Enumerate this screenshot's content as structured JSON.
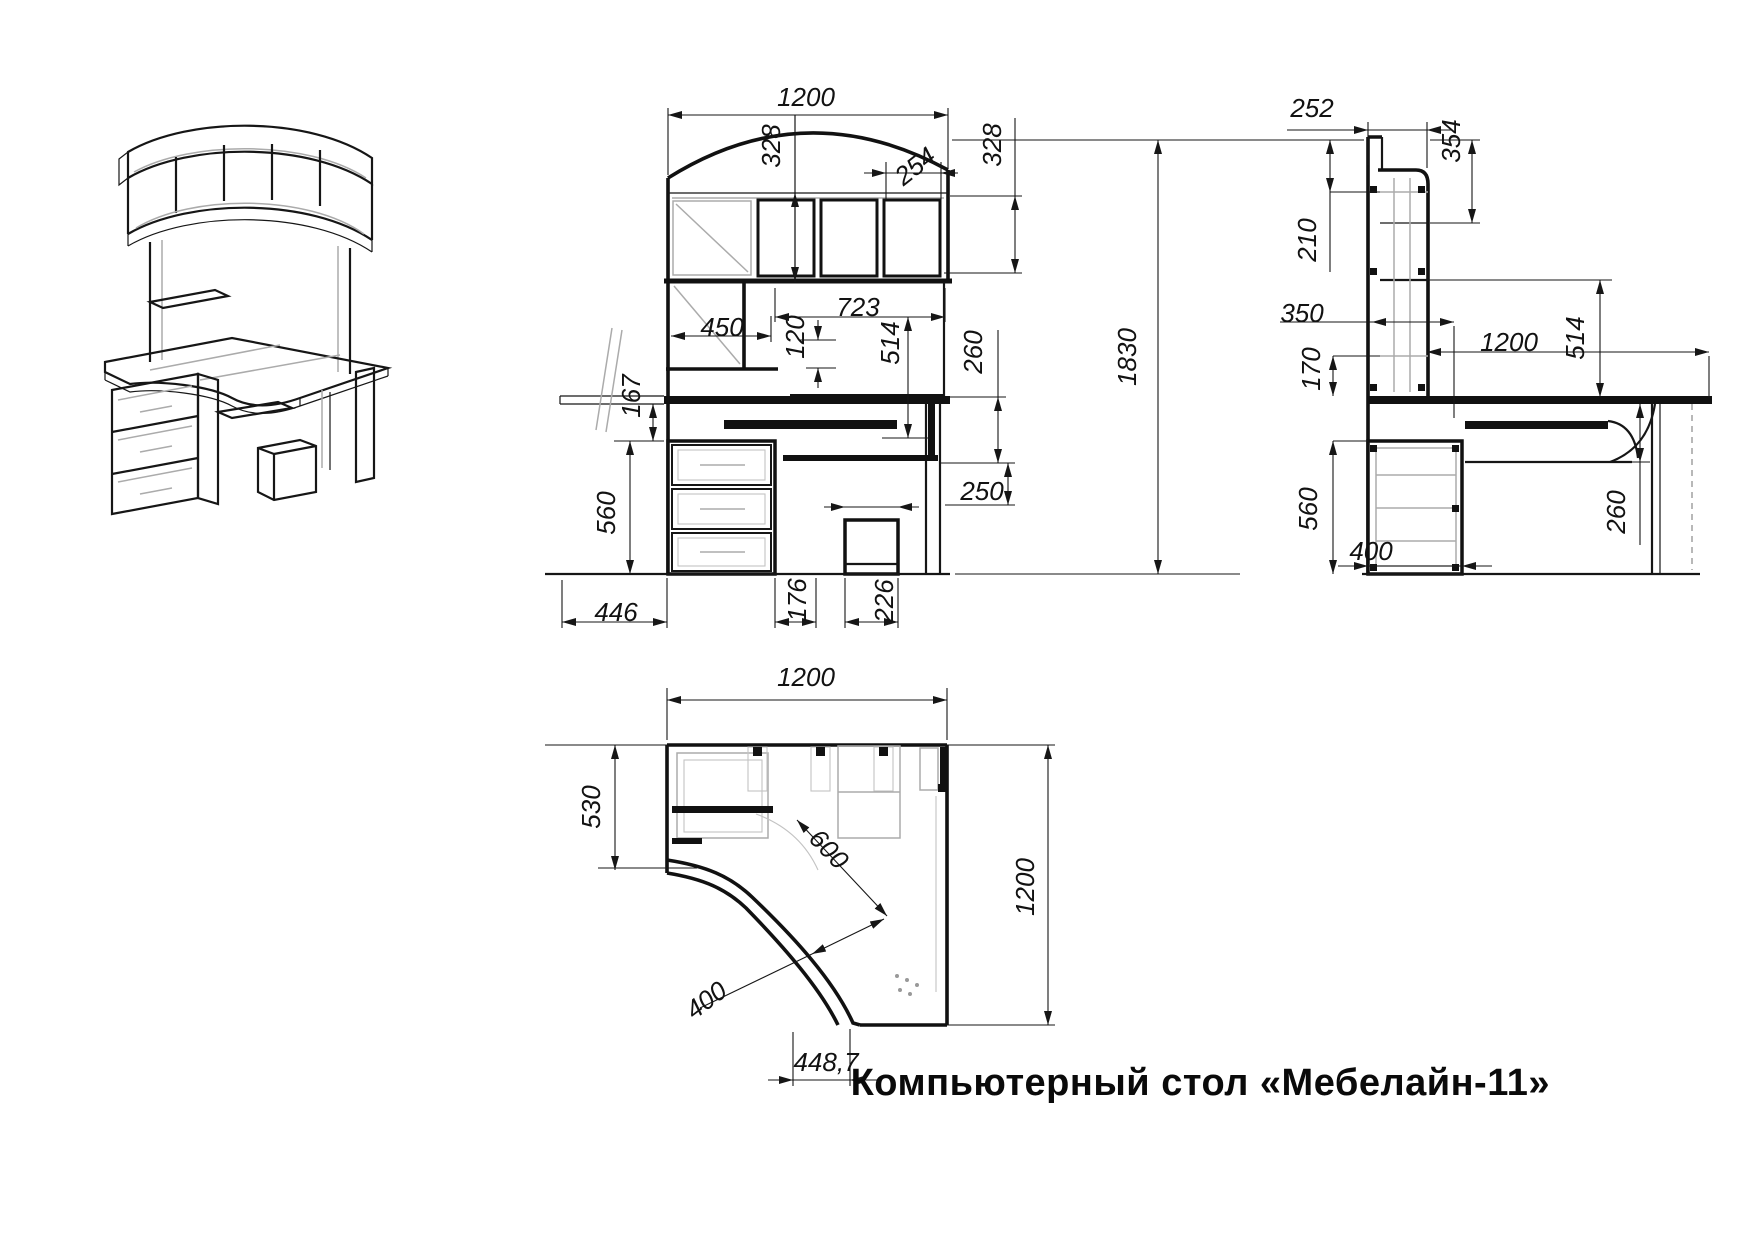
{
  "title": "Компьютерный стол «Мебелайн-11»",
  "colors": {
    "line": "#141414",
    "detail": "#ababab",
    "background": "#ffffff"
  },
  "views": {
    "front": {
      "dims": {
        "width": "1200",
        "hutch_left_h": "328",
        "shelf_w": "254",
        "hutch_right_h": "328",
        "niche_w": "450",
        "niche_offset": "120",
        "opening_w": "723",
        "opening_h": "514",
        "shelf_drop": "260",
        "tray_gap": "167",
        "drawer_h": "560",
        "box_h": "250",
        "drawer_w": "446",
        "gap_w": "176",
        "cpu_w": "226",
        "total_h": "1830"
      }
    },
    "side": {
      "dims": {
        "top_depth": "252",
        "hutch_h": "354",
        "shelf_h": "210",
        "tray_depth": "350",
        "desk_depth": "1200",
        "under_h": "514",
        "tray_drop": "170",
        "drawer_h": "560",
        "edge_h": "260",
        "cabinet_depth": "400"
      }
    },
    "plan": {
      "dims": {
        "width": "1200",
        "left_depth": "530",
        "diag_inner": "600",
        "diag_outer": "400",
        "depth": "1200",
        "front_w": "448,7"
      }
    }
  }
}
